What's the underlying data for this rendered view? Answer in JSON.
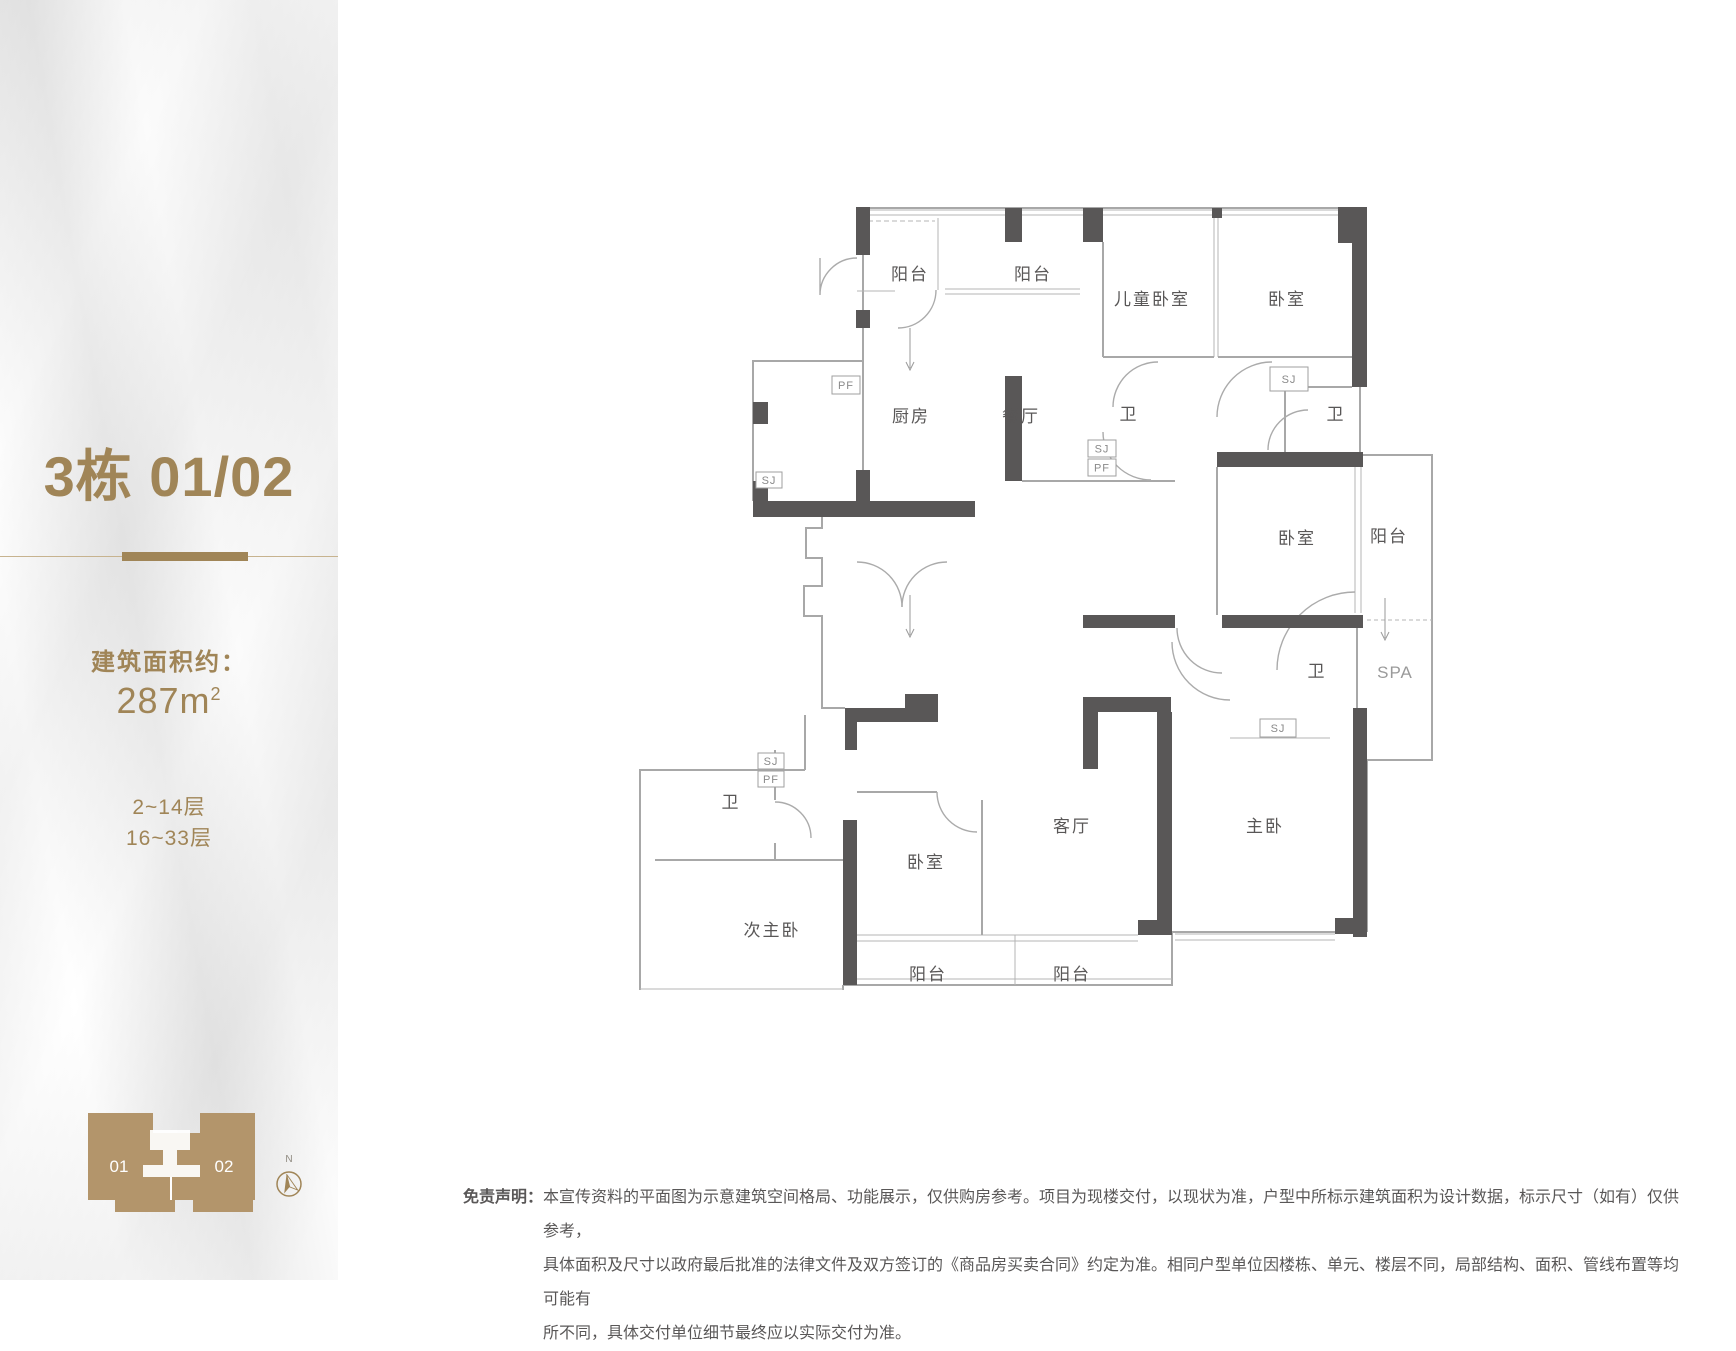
{
  "sidebar": {
    "accent_color": "#A08557",
    "title": "3栋 01/02",
    "area_label": "建筑面积约：",
    "area_value": "287m",
    "area_sup": "2",
    "floors_line1": "2~14层",
    "floors_line2": "16~33层",
    "building_icon": {
      "color": "#B3956B",
      "unit_left": "01",
      "unit_right": "02"
    },
    "compass": {
      "north_label": "N"
    }
  },
  "floorplan": {
    "wall_color": "#595757",
    "line_color": "#a8a8a8",
    "rooms": [
      {
        "label": "阳台",
        "x": 300,
        "y": 110
      },
      {
        "label": "阳台",
        "x": 423,
        "y": 110
      },
      {
        "label": "儿童卧室",
        "x": 542,
        "y": 135
      },
      {
        "label": "卧室",
        "x": 677,
        "y": 135
      },
      {
        "label": "厨房",
        "x": 301,
        "y": 252
      },
      {
        "label": "餐厅",
        "x": 411,
        "y": 252
      },
      {
        "label": "卫",
        "x": 519,
        "y": 250
      },
      {
        "label": "卫",
        "x": 726,
        "y": 250
      },
      {
        "label": "卧室",
        "x": 687,
        "y": 374
      },
      {
        "label": "阳台",
        "x": 779,
        "y": 372
      },
      {
        "label": "卫",
        "x": 707,
        "y": 507
      },
      {
        "label": "SPA",
        "x": 785,
        "y": 508,
        "muted": true
      },
      {
        "label": "客厅",
        "x": 462,
        "y": 662
      },
      {
        "label": "主卧",
        "x": 655,
        "y": 662
      },
      {
        "label": "卧室",
        "x": 316,
        "y": 698
      },
      {
        "label": "次主卧",
        "x": 162,
        "y": 766
      },
      {
        "label": "卫",
        "x": 121,
        "y": 638
      },
      {
        "label": "阳台",
        "x": 318,
        "y": 810
      },
      {
        "label": "阳台",
        "x": 462,
        "y": 810
      }
    ],
    "tags": [
      {
        "label": "PF",
        "x": 222,
        "y": 206,
        "w": 28,
        "h": 18
      },
      {
        "label": "SJ",
        "x": 146,
        "y": 302,
        "w": 26,
        "h": 16
      },
      {
        "label": "SJ",
        "x": 478,
        "y": 270,
        "w": 28,
        "h": 17
      },
      {
        "label": "PF",
        "x": 478,
        "y": 289,
        "w": 28,
        "h": 17
      },
      {
        "label": "SJ",
        "x": 660,
        "y": 197,
        "w": 38,
        "h": 24
      },
      {
        "label": "SJ",
        "x": 650,
        "y": 549,
        "w": 36,
        "h": 18
      },
      {
        "label": "SJ",
        "x": 148,
        "y": 583,
        "w": 26,
        "h": 16
      },
      {
        "label": "PF",
        "x": 148,
        "y": 601,
        "w": 26,
        "h": 16
      }
    ]
  },
  "disclaimer": {
    "label": "免责声明：",
    "lines": [
      "本宣传资料的平面图为示意建筑空间格局、功能展示，仅供购房参考。项目为现楼交付，以现状为准，户型中所标示建筑面积为设计数据，标示尺寸（如有）仅供参考，",
      "具体面积及尺寸以政府最后批准的法律文件及双方签订的《商品房买卖合同》约定为准。相同户型单位因楼栋、单元、楼层不同，局部结构、面积、管线布置等均可能有",
      "所不同，具体交付单位细节最终应以实际交付为准。"
    ]
  }
}
